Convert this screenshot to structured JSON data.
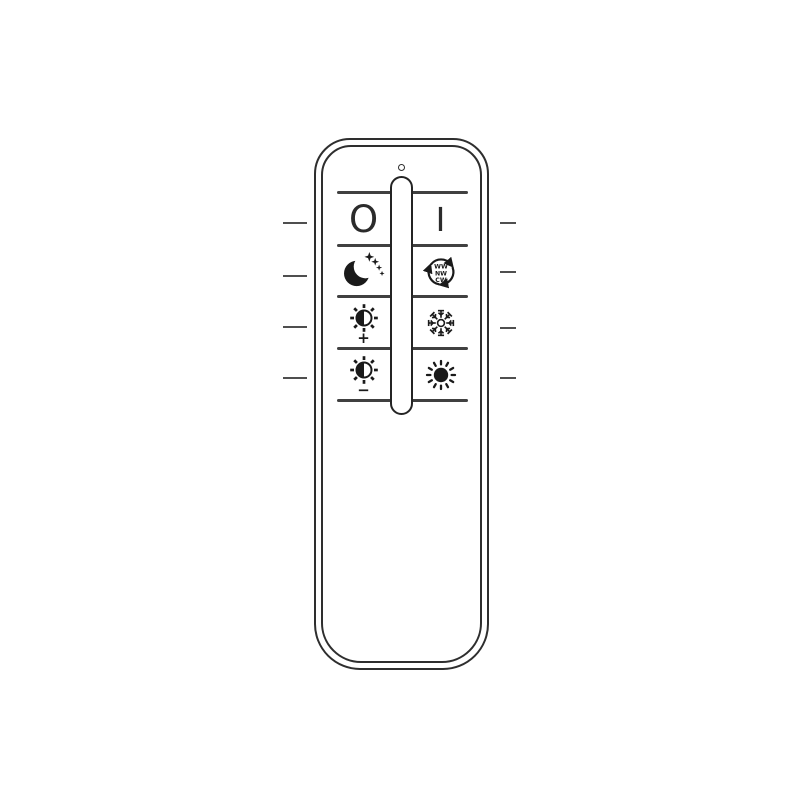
{
  "colors": {
    "background": "#ffffff",
    "outline": "#2e2e2e",
    "separator": "#404040",
    "callout_line": "#4f4f4f",
    "icon": "#1a1a1a"
  },
  "remote": {
    "type": "remote-control-line-drawing",
    "led_indicator": "power-led-hole",
    "buttons": {
      "off": {
        "label": "O",
        "meaning": "power off"
      },
      "on": {
        "label": "I",
        "meaning": "power on"
      },
      "night_mode": {
        "icon": "moon-stars-icon",
        "meaning": "night / sleep mode"
      },
      "color_cycle": {
        "icon": "recycle-arrows-icon",
        "line1": "WW",
        "line2": "NW",
        "line3": "CW",
        "meaning": "cycle warm/neutral/cool white"
      },
      "brightness_up": {
        "icon": "sun-half-icon",
        "sign": "+",
        "meaning": "brightness up"
      },
      "cool_white": {
        "icon": "snowflake-icon",
        "meaning": "cool white"
      },
      "brightness_down": {
        "icon": "sun-half-icon",
        "sign": "−",
        "meaning": "brightness down"
      },
      "warm_bright": {
        "icon": "sun-filled-icon",
        "meaning": "full brightness / warm"
      }
    },
    "callout_lines": {
      "left_count": 4,
      "right_count": 4
    }
  }
}
